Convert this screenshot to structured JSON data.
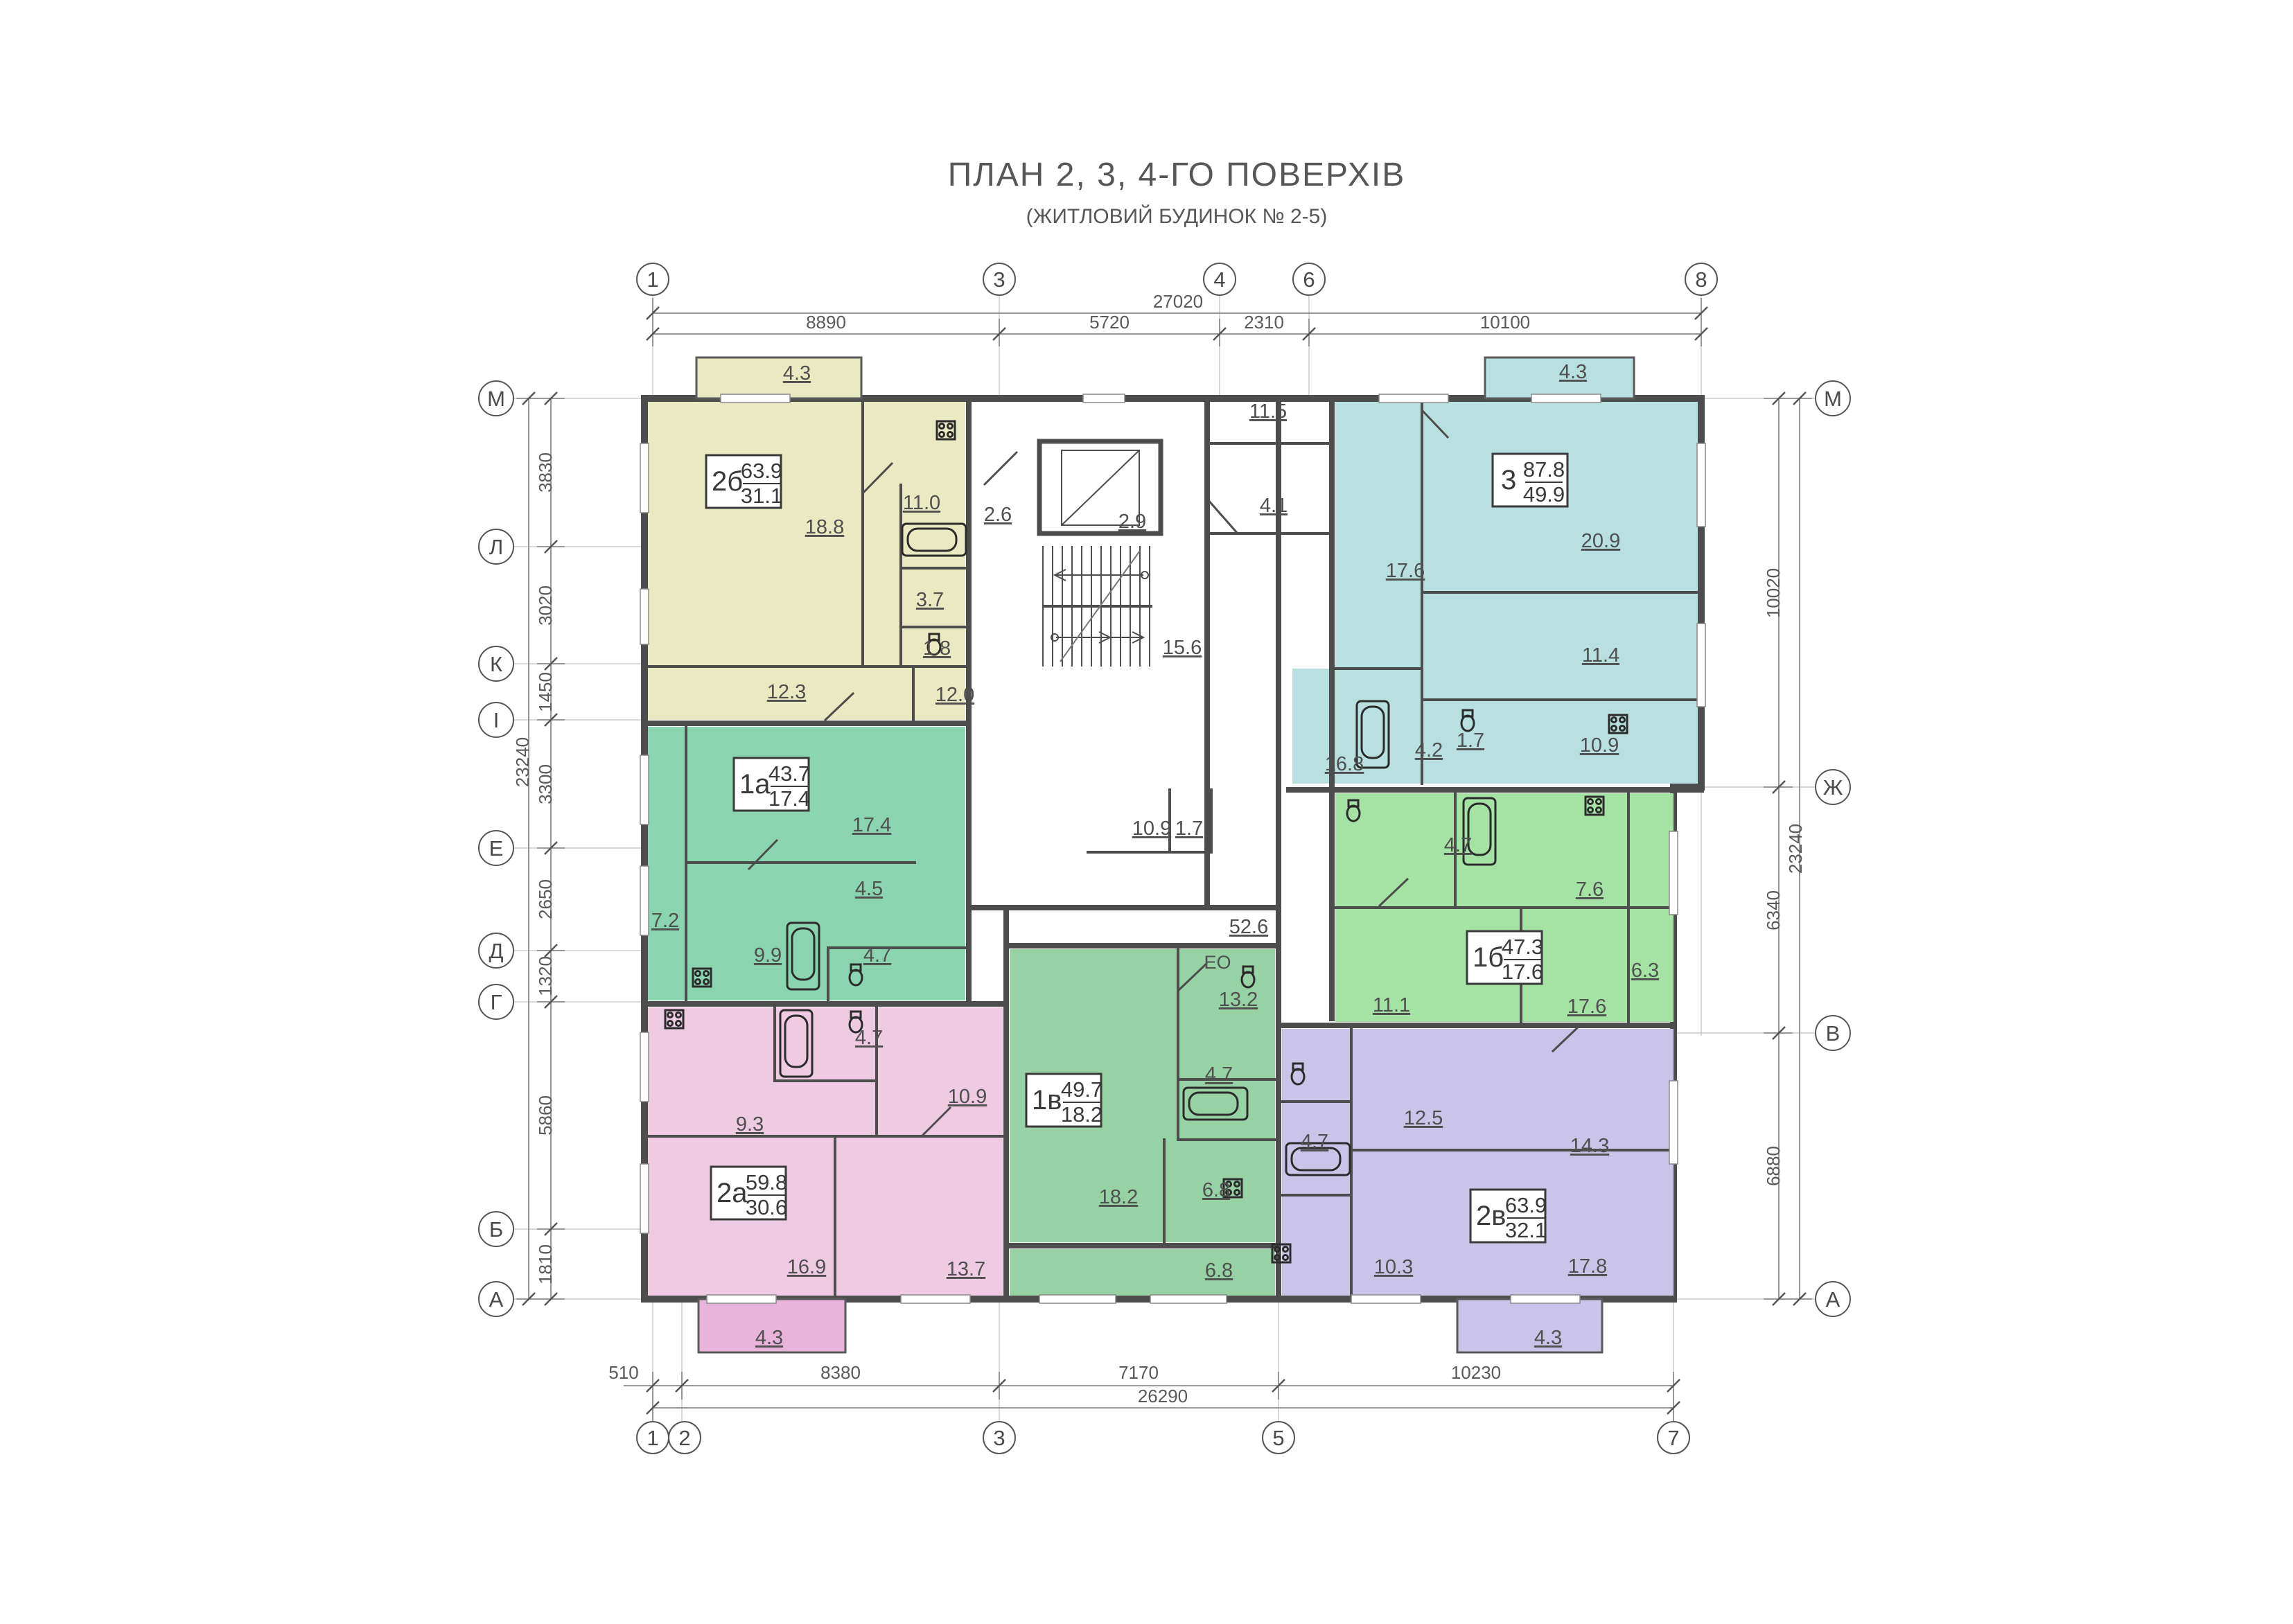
{
  "title": {
    "main": "ПЛАН 2, 3, 4-ГО ПОВЕРХІВ",
    "sub": "(ЖИТЛОВИЙ БУДИНОК № 2-5)"
  },
  "grid": {
    "top_axes": [
      "1",
      "3",
      "4",
      "6",
      "8"
    ],
    "bottom_axes": [
      "1",
      "2",
      "3",
      "5",
      "7"
    ],
    "left_axes": [
      "М",
      "Л",
      "К",
      "І",
      "Е",
      "Д",
      "Г",
      "Б",
      "А"
    ],
    "right_axes": [
      "М",
      "Ж",
      "В",
      "А"
    ],
    "dims_top": {
      "total": "27020",
      "segments": [
        "8890",
        "5720",
        "2310",
        "10100"
      ]
    },
    "dims_bottom": {
      "total": "26290",
      "segments": [
        "510",
        "8380",
        "7170",
        "10230"
      ]
    },
    "dims_left": {
      "total": "23240",
      "segments": [
        "3830",
        "3020",
        "1450",
        "3300",
        "2650",
        "1320",
        "5860",
        "1810"
      ]
    },
    "dims_right": {
      "total": "23240",
      "segments": [
        "10020",
        "6340",
        "6880"
      ]
    }
  },
  "apartments": [
    {
      "id": "2б",
      "total": "63.9",
      "living": "31.1",
      "color": "#e9e9c2",
      "balcony": "4.3",
      "rooms": [
        "18.8",
        "11.0",
        "3.7",
        "1.8",
        "12.3",
        "12.0"
      ]
    },
    {
      "id": "3",
      "total": "87.8",
      "living": "49.9",
      "color": "#b9e0e1",
      "balcony": "4.3",
      "rooms": [
        "17.6",
        "20.9",
        "11.4",
        "16.8",
        "4.2",
        "1.7",
        "10.9"
      ]
    },
    {
      "id": "1а",
      "total": "43.7",
      "living": "17.4",
      "color": "#8ad5b0",
      "rooms": [
        "17.4",
        "4.5",
        "7.2",
        "9.9",
        "4.7"
      ]
    },
    {
      "id": "1б",
      "total": "47.3",
      "living": "17.6",
      "color": "#a5e3a5",
      "rooms": [
        "4.7",
        "7.6",
        "6.3",
        "11.1",
        "17.6"
      ]
    },
    {
      "id": "2а",
      "total": "59.8",
      "living": "30.6",
      "color": "#eecae3",
      "balcony": "4.3",
      "balcony_color": "#e9b4db",
      "rooms": [
        "9.3",
        "4.7",
        "10.9",
        "16.9",
        "13.7"
      ]
    },
    {
      "id": "1в",
      "total": "49.7",
      "living": "18.2",
      "color": "#97d2a4",
      "tag": "ЕО",
      "rooms": [
        "13.2",
        "4.7",
        "18.2",
        "6.8",
        "6.8"
      ]
    },
    {
      "id": "2в",
      "total": "63.9",
      "living": "32.1",
      "color": "#cac4e9",
      "balcony": "4.3",
      "rooms": [
        "12.5",
        "14.3",
        "4.7",
        "10.3",
        "17.8"
      ]
    }
  ],
  "common": {
    "rooms": [
      "2.6",
      "2.9",
      "11.5",
      "4.1",
      "15.6",
      "10.9",
      "1.7",
      "52.6"
    ]
  }
}
